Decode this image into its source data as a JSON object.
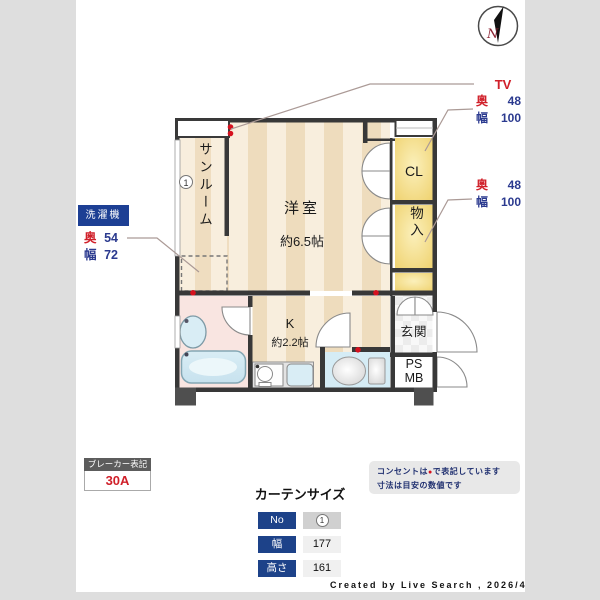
{
  "compass": {
    "n": "N"
  },
  "plan": {
    "rooms": {
      "sunroom": "サンルーム",
      "marker1": "1",
      "living": "洋室",
      "living_size": "約6.5帖",
      "cl": "CL",
      "storage": "物入",
      "genkan": "玄関",
      "ps": "PS",
      "mb": "MB",
      "kitchen": "K",
      "kitchen_size": "約2.2帖"
    }
  },
  "annotations": {
    "tv_label": "TV",
    "closet1": {
      "depth_label": "奥",
      "depth": "48",
      "width_label": "幅",
      "width": "100"
    },
    "closet2": {
      "depth_label": "奥",
      "depth": "48",
      "width_label": "幅",
      "width": "100"
    },
    "washer": {
      "title": "洗濯機",
      "depth_label": "奥",
      "depth": "54",
      "width_label": "幅",
      "width": "72"
    }
  },
  "breaker": {
    "title": "ブレーカー表記",
    "value": "30A"
  },
  "curtain": {
    "title": "カーテンサイズ",
    "rows": [
      {
        "label": "No",
        "value": "1"
      },
      {
        "label": "幅",
        "value": "177"
      },
      {
        "label": "高さ",
        "value": "161"
      }
    ]
  },
  "note": {
    "line1_prefix": "コンセントは",
    "symbol": "●",
    "line1_suffix": "で表記しています",
    "line2": "寸法は目安の数値です"
  },
  "credit": "Created by Live Search , 2026/4",
  "colors": {
    "accent_navy": "#1d4289",
    "accent_red": "#d0202a",
    "wall": "#383838",
    "floor_light": "#f8eedd",
    "floor_dark": "#eedcbd",
    "closet_yellow": "#f2d678",
    "bath_pink": "#f9e5e1",
    "water_blue": "#d5ecf5"
  }
}
